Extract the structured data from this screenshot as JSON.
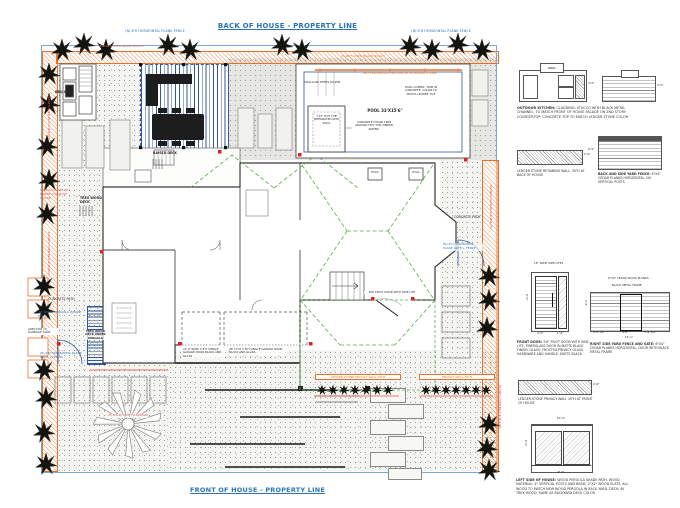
{
  "titles": {
    "back": "BACK OF HOUSE - PROPERTY LINE",
    "front": "FRONT OF HOUSE - PROPERTY LINE"
  },
  "colors": {
    "title_blue": "#2e74b5",
    "fence_blue": "#7ba7d7",
    "pool_blue": "#33589b",
    "accent_orange": "#e8702a",
    "note_red": "#d9534a",
    "roof_green": "#5ba84c"
  },
  "plan": {
    "labels": {
      "fence_top_left": "(N) 6'H HORIZONTAL PLANK FENCE",
      "fence_top_right": "(N) 6'H HORIZONTAL PLANK FENCE",
      "plants_top_left": "PLANTS OVER BLACK MULCH",
      "plants_top_mid": "PLANTS OVER BLACK MULCH",
      "plants_left_1": "PLANTS OVER BLACK MULCH",
      "plants_left_2": "PLANTS OVER BLACK MULCH",
      "plants_right_1": "PLANTS OVER BLACK MULCH",
      "plants_right_2": "PLANTS OVER BLACK MULCH",
      "bbq_area": "BBQ AREA",
      "raised_deck": "RAISED DECK",
      "waterfall": "48\"H WATERFALL FEATURE WITH LEDGER STONE",
      "shallow_steps": "SHALLOW STEPS DOWN",
      "pool": "POOL 33'X15'6\"",
      "pool_coping": "POOL COPING: TRIM IN CONCRETE, COLOR TO MATCH LEDGER TILE",
      "hot_tub": "7'X7' HOT TUB INTEGRATED INTO POOL",
      "hot_tub_trim": "CONCRETE COLOR TRIM AROUND HOT TUB (UNDER WATER)",
      "hvac": "HVAC",
      "stucco_posts": "STUCCO POSTS TO MATCH COLOR OF HOUSE",
      "trex_deck": "TREX WOOD DECK",
      "concrete_path_left": "CONCRETE PATH",
      "concrete_path_right": "CONCRETE PATH",
      "pergola_note": "(N) WOOD PERGOLA (SHADE PATH)",
      "pergola_deck": "TREX WOOD DECK UNDER PERGOLA",
      "gate_left": "(N) 6'H HORIZONTAL PLANK GATE + FENCE",
      "gate_right": "(N) 6'H HORIZONTAL PLANK GATE + FENCE",
      "garbage": "AREA FOR (3) GARBAGE CANS",
      "garage_door_a": "(A) 8' WIDE X 8'H SINGLE GARAGE DOOR BLACK AND GLASS",
      "garage_door_b": "(B) 17'W X 8'H SINGLE GARAGE DOOR BLACK AND GLASS",
      "palm": "(E) PALM TREE TO REMAIN",
      "privacy_wall_left": "LEDGER STONE PRIVACY WALL 30\"H",
      "privacy_wall_right": "PRIVACY WALL 30\"H",
      "pivot_door": "8'W PIVOT DOOR WITH SIDE LITE"
    }
  },
  "details": {
    "kitchen": {
      "grill": "GRILL",
      "dim_front": "3'-0\"",
      "dim_side": "3'-0\"",
      "caption_title": "OUTDOOR KITCHEN:",
      "caption_body": "CLADDING: STUCCO WITH BLACK METAL CHANNEL, TO MATCH FRONT OF HOUSE FACADE ON 2ND STORY. COUNTERTOP: CONCRETE TOP TO MATCH LEDGER STONE COLOR"
    },
    "retaining_wall": {
      "caption": "LEDGER STONE RETAINING WALL, 30\"H AT BACK OF HOUSE",
      "dim": "2'-6\""
    },
    "back_fence": {
      "caption_title": "BACK AND SIDE YARD FENCE:",
      "caption_body": "6\"X4\" CEDAR PLANKS HORIZONTAL, NO VERTICAL POSTS",
      "dim": "6'-0\""
    },
    "front_door": {
      "note": "18\" WIDE SIDE LITES",
      "dim_h": "8'-0\"",
      "dim_w1": "4'-0\"",
      "dim_w2": "1'-6\"",
      "caption_title": "FRONT DOOR:",
      "caption_body": "3'6\" PIVOT DOOR WITH SIDE-LITE. FIBERGLASS DOOR IN MATTE BLACK FINISH. GLASS: FROSTED PRIVACY GLASS. HARDWARE AND HANDLE: MATTE BLACK"
    },
    "side_gate": {
      "note_planks": "6\"X4\" CEDAR WOOD PLANKS",
      "note_frame": "BLACK METAL FRAME",
      "dim_left": "6'-6\"",
      "dim_b1": "5'-6 1/2\"",
      "dim_b2": "4'-0\"",
      "dim_b3": "5'-6 1/2\"",
      "dim_total": "15'-1\"",
      "caption_title": "RIGHT SIDE YARD FENCE AND GATE:",
      "caption_body": "6\"X4\" CEDAR PLANKS HORIZONTAL, DOOR WITH BLACK METAL FRAME"
    },
    "privacy_wall": {
      "caption": "LEDGER STONE PRIVACY WALL 30\"H AT FRONT OF HOUSE",
      "dim": "2'-6\""
    },
    "pergola": {
      "dim_top": "10'-0\"",
      "dim_left": "8'-0\"",
      "dim_bottom": "8'-0\"",
      "caption_title": "LEFT SIDE OF HOUSE:",
      "caption_body": "WOOD PERGOLA SHADE PATH. WOOD MATERIAL: 4\" VERTICAL POSTS AND BEAM, 2\"X2\" WOOD SLATS. ALL WOOD TO MATCH NEW WOOD PERGOLA IN BACK YARD. DECK: IN TREX WOOD, SAME AS BACKYARD DECK COLOR"
    }
  }
}
